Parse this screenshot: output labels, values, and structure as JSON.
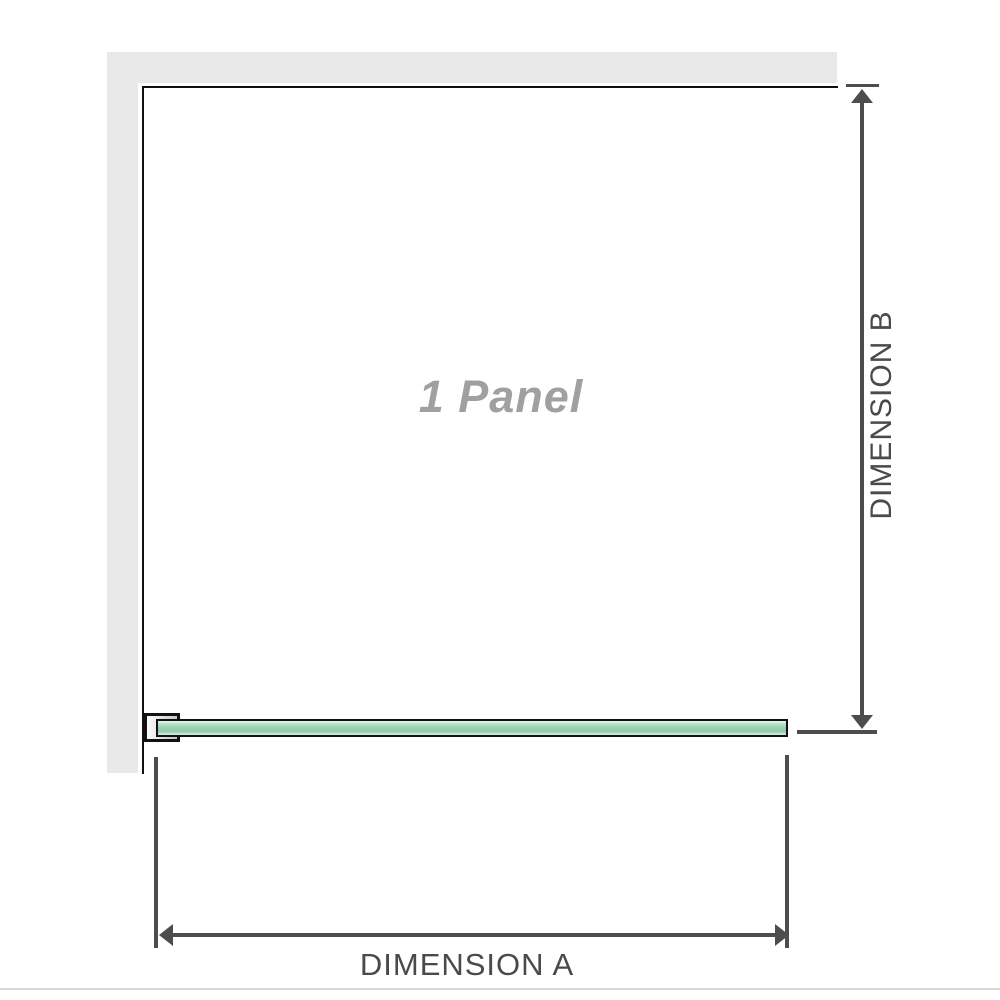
{
  "diagram": {
    "panel_label": "1 Panel",
    "dimension_a": {
      "label": "DIMENSION A"
    },
    "dimension_b": {
      "label": "DIMENSION B"
    }
  },
  "colors": {
    "wall": "#e9e9e9",
    "outline": "#111111",
    "dim_line": "#4d4d4d",
    "dim_text": "#4a4a4a",
    "panel_label_text": "#a0a0a0",
    "glass_border": "#111111",
    "glass_light": "#edf7f1",
    "glass_light2": "#b5e0c7",
    "glass_mid": "#9ad2b3",
    "glass_dark": "#8fcba9",
    "glass_bottom": "#dcefe4",
    "bracket_light": "#fbfbfb",
    "bracket_dark": "#c6c6c6",
    "baseline": "#d9d8d0"
  }
}
